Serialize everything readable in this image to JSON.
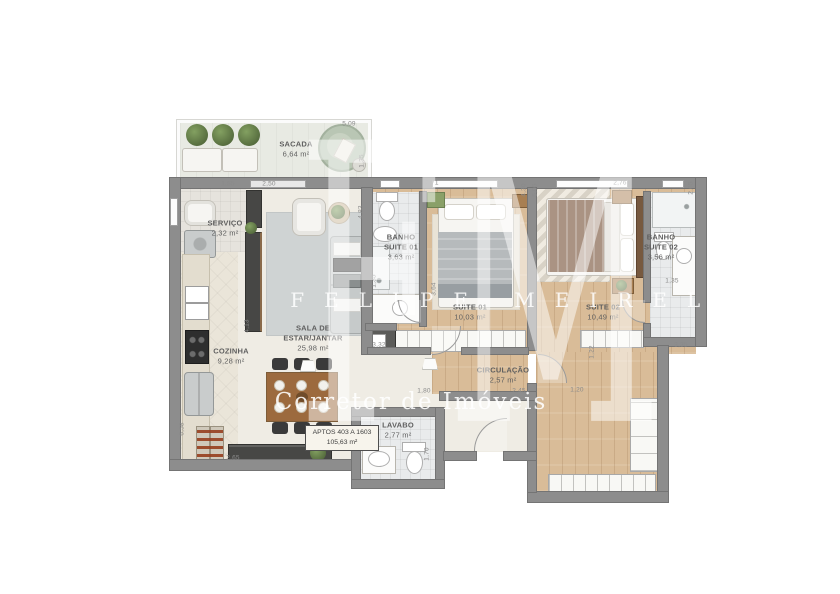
{
  "watermark": {
    "monogram": "FM",
    "name": "FELIPE MEIRELLES",
    "tagline": "Corretor de Imóveis"
  },
  "unit_box": {
    "line1": "APTOS 403 A 1603",
    "line2": "105,63 m²"
  },
  "colors": {
    "wall": "#8d8d8d",
    "wood": "#d9bc98",
    "label": "#5f5f5f",
    "dim": "#8a8a8a",
    "watermark": "#ffffff"
  },
  "rooms": [
    {
      "id": "sacada",
      "name": "SACADA",
      "area": "6,64 m²",
      "x": 296,
      "y": 149
    },
    {
      "id": "servico",
      "name": "SERVIÇO",
      "area": "2,32 m²",
      "x": 225,
      "y": 228
    },
    {
      "id": "cozinha",
      "name": "COZINHA",
      "area": "9,28 m²",
      "x": 231,
      "y": 356
    },
    {
      "id": "sala-estar-jantar",
      "name": "SALA DE\nESTAR/JANTAR",
      "area": "25,98 m²",
      "x": 313,
      "y": 338
    },
    {
      "id": "banho-suite-01",
      "name": "BANHO\nSUITE 01",
      "area": "3,63 m²",
      "x": 401,
      "y": 247
    },
    {
      "id": "suite-01",
      "name": "SUITE 01",
      "area": "10,03 m²",
      "x": 470,
      "y": 312
    },
    {
      "id": "suite-02",
      "name": "SUITE 02",
      "area": "10,49 m²",
      "x": 603,
      "y": 312
    },
    {
      "id": "banho-suite-02",
      "name": "BANHO\nSUITE 02",
      "area": "3,56 m²",
      "x": 661,
      "y": 247
    },
    {
      "id": "circulacao",
      "name": "CIRCULAÇÃO",
      "area": "2,57 m²",
      "x": 503,
      "y": 375
    },
    {
      "id": "lavabo",
      "name": "LAVABO",
      "area": "2,77 m²",
      "x": 398,
      "y": 430
    }
  ],
  "dimensions": [
    {
      "text": "5,09",
      "x": 349,
      "y": 124
    },
    {
      "text": "1,35",
      "x": 362,
      "y": 161,
      "v": 1
    },
    {
      "text": "1,55",
      "x": 228,
      "y": 184
    },
    {
      "text": "2,50",
      "x": 269,
      "y": 184
    },
    {
      "text": "4,83",
      "x": 361,
      "y": 212,
      "v": 1
    },
    {
      "text": "2,71",
      "x": 432,
      "y": 183
    },
    {
      "text": "4,30",
      "x": 524,
      "y": 190,
      "v": 1
    },
    {
      "text": "5,05",
      "x": 535,
      "y": 190,
      "v": 1
    },
    {
      "text": "2,76",
      "x": 620,
      "y": 183
    },
    {
      "text": "2,65",
      "x": 691,
      "y": 188,
      "v": 1
    },
    {
      "text": "1,35",
      "x": 374,
      "y": 281,
      "v": 1
    },
    {
      "text": "3,64",
      "x": 434,
      "y": 289,
      "v": 1
    },
    {
      "text": "4,13",
      "x": 247,
      "y": 326,
      "v": 1
    },
    {
      "text": "3,32",
      "x": 379,
      "y": 345
    },
    {
      "text": "1,35",
      "x": 672,
      "y": 281
    },
    {
      "text": "3,35",
      "x": 681,
      "y": 345
    },
    {
      "text": "1,22",
      "x": 592,
      "y": 352,
      "v": 1
    },
    {
      "text": "1,80",
      "x": 424,
      "y": 391
    },
    {
      "text": "2,45",
      "x": 519,
      "y": 391
    },
    {
      "text": "1,20",
      "x": 577,
      "y": 390
    },
    {
      "text": "1,70",
      "x": 427,
      "y": 454,
      "v": 1
    },
    {
      "text": "6,58",
      "x": 182,
      "y": 429,
      "v": 1
    },
    {
      "text": "2,65",
      "x": 233,
      "y": 458
    }
  ]
}
